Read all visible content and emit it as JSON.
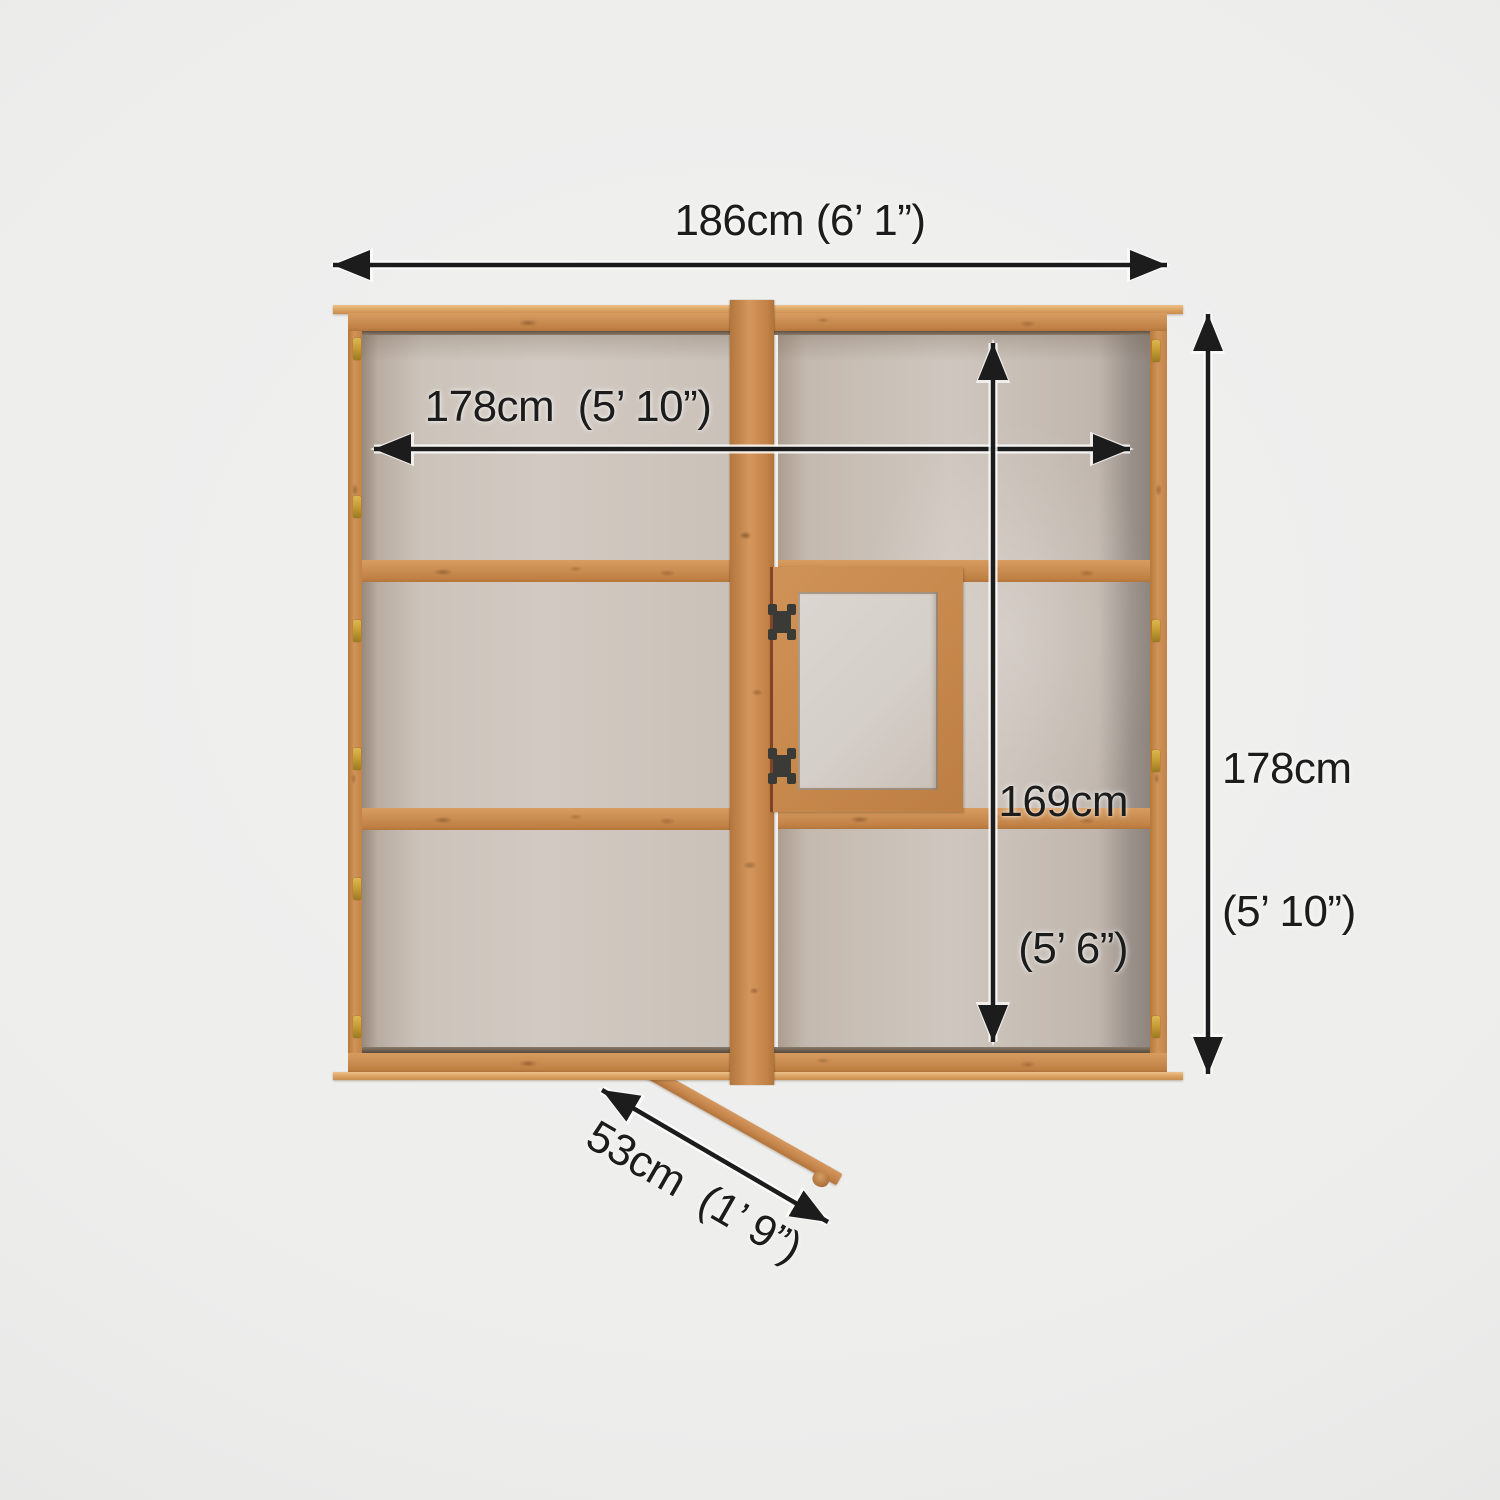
{
  "diagram": {
    "type": "product-dimension-plan-view",
    "subject": "wooden-greenhouse-frame",
    "dimensions": {
      "overall_width": {
        "label": "186cm (6’ 1”)"
      },
      "internal_width": {
        "label": "178cm  (5’ 10”)"
      },
      "overall_depth": {
        "line1": "178cm",
        "line2": "(5’ 10”)"
      },
      "internal_depth": {
        "line1": "169cm",
        "line2": "(5’ 6”)"
      },
      "door_opening": {
        "label": "53cm  (1’ 9”)"
      }
    },
    "colors": {
      "wood": "#c8854a",
      "wood_light": "#dca468",
      "glazing": "#cdc5bd",
      "dimension_lines": "#1c1c1c",
      "background": "#ececeb"
    }
  }
}
